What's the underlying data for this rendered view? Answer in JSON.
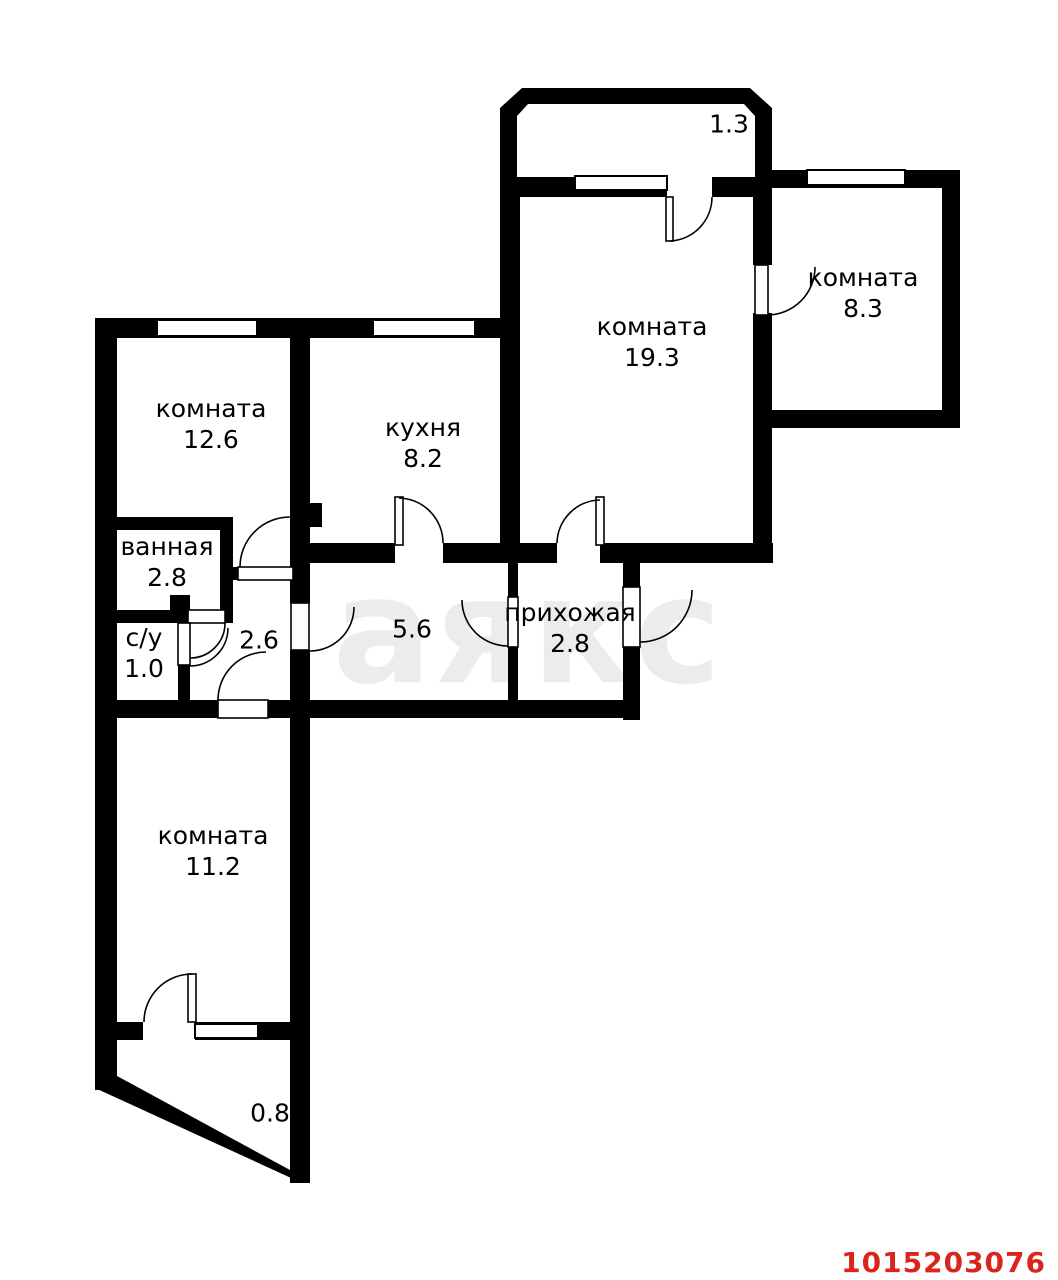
{
  "watermark": {
    "text": "аякс"
  },
  "listing_id": "1015203076",
  "colors": {
    "wall": "#000000",
    "background": "#ffffff",
    "watermark": "#ececec",
    "listing_id_red": "#da251d"
  },
  "rooms": {
    "balcony_top": {
      "area": "1.3"
    },
    "room_19": {
      "name": "комната",
      "area": "19.3"
    },
    "room_8": {
      "name": "комната",
      "area": "8.3"
    },
    "room_12": {
      "name": "комната",
      "area": "12.6"
    },
    "kitchen": {
      "name": "кухня",
      "area": "8.2"
    },
    "bathroom": {
      "name": "ванная",
      "area": "2.8"
    },
    "toilet": {
      "name": "с/у",
      "area": "1.0"
    },
    "corridor_small": {
      "area": "2.6"
    },
    "corridor": {
      "area": "5.6"
    },
    "hallway": {
      "name": "прихожая",
      "area": "2.8"
    },
    "room_11": {
      "name": "комната",
      "area": "11.2"
    },
    "balcony_bottom": {
      "area": "0.8"
    }
  }
}
